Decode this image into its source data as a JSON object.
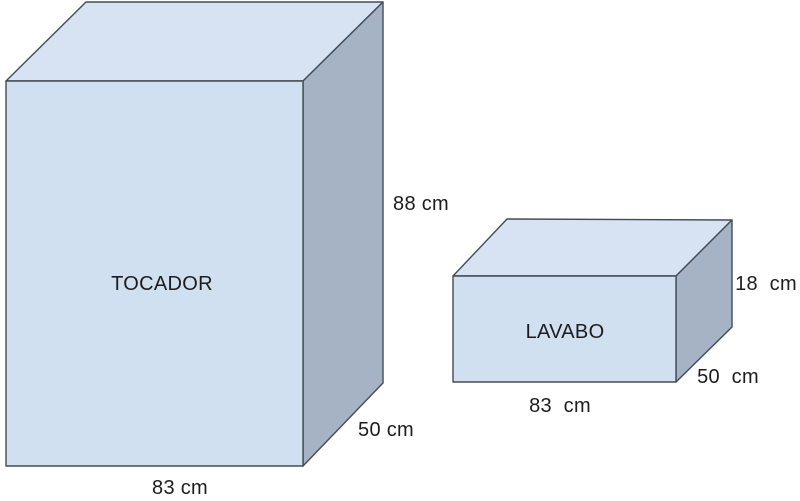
{
  "colors": {
    "background": "#ffffff",
    "face_front": "#d0e0f0",
    "face_top": "#d7e3f2",
    "face_side": "#a5b3c5",
    "stroke": "#424c57",
    "text": "#1c1c1e"
  },
  "boxes": [
    {
      "name": "TOCADOR",
      "width_label": "83 cm",
      "depth_label": "50 cm",
      "height_label": "88 cm"
    },
    {
      "name": "LAVABO",
      "width_label": "83  cm",
      "depth_label": "50  cm",
      "height_label": "18  cm"
    }
  ]
}
